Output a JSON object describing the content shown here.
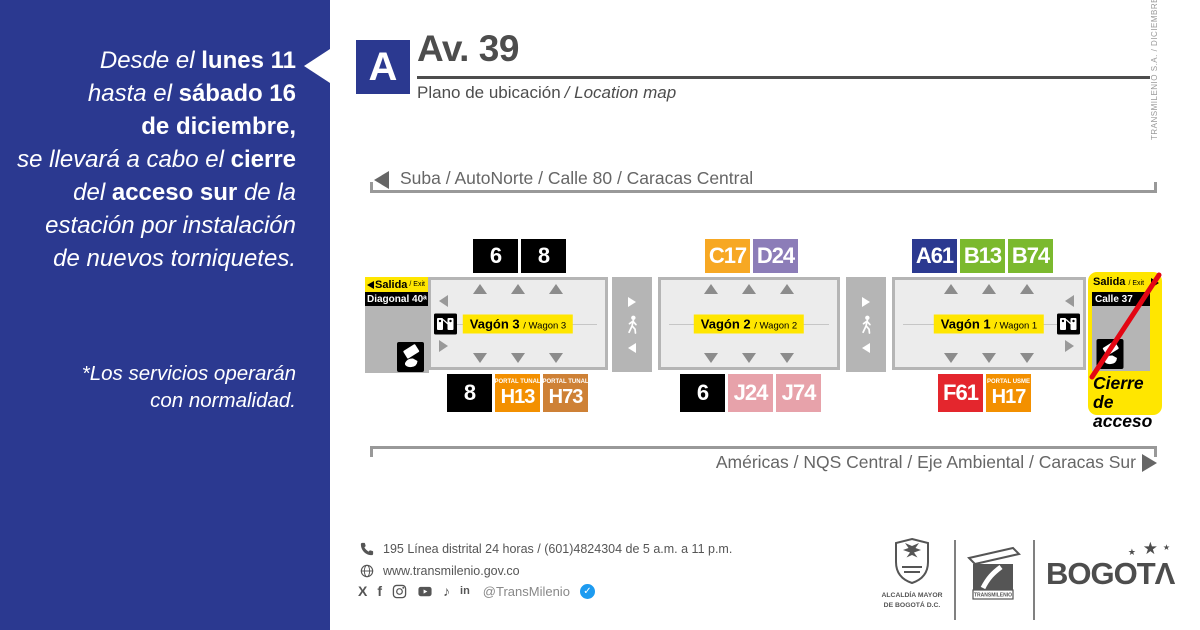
{
  "colors": {
    "brand_blue": "#2B3990",
    "accent_yellow": "#FFE600",
    "platform_gray": "#B5B5B5",
    "closure_red": "#E30613",
    "verified_blue": "#1D9BF0"
  },
  "sidebar": {
    "message_lines": [
      [
        {
          "t": "Desde el ",
          "s": "i"
        },
        {
          "t": "lunes 11",
          "s": "b"
        }
      ],
      [
        {
          "t": "hasta el ",
          "s": "i"
        },
        {
          "t": "sábado 16",
          "s": "b"
        }
      ],
      [
        {
          "t": "de diciembre,",
          "s": "b"
        }
      ],
      [
        {
          "t": "se llevará a cabo el ",
          "s": "i"
        },
        {
          "t": "cierre",
          "s": "b"
        }
      ],
      [
        {
          "t": "del ",
          "s": "i"
        },
        {
          "t": "acceso sur",
          "s": "b"
        },
        {
          "t": " de la",
          "s": "i"
        }
      ],
      [
        {
          "t": "estación por instalación",
          "s": "i"
        }
      ],
      [
        {
          "t": "de nuevos torniquetes.",
          "s": "i"
        }
      ]
    ],
    "footnote_lines": [
      "*Los servicios operarán",
      "con normalidad."
    ]
  },
  "header": {
    "station_letter": "A",
    "station_name": "Av. 39",
    "subtitle_es": "Plano de ubicación",
    "subtitle_en": "/ Location map",
    "credit_vertical": "TRANSMILENIO S.A. / DICIEMBRE - 2023"
  },
  "directions": {
    "top_label": "Suba / AutoNorte / Calle 80 / Caracas Central",
    "bottom_label": "Américas / NQS Central / Eje Ambiental / Caracas Sur"
  },
  "station": {
    "exit_left": {
      "salida": "Salida",
      "exit_suffix": "/ Exit",
      "street": "Diagonal 40ᵃ"
    },
    "wagons": [
      {
        "id": "wagon-3",
        "name": "Vagón 3",
        "name_en": "/ Wagon 3",
        "top_badges": [
          {
            "label": "6",
            "bg": "#000000"
          },
          {
            "label": "8",
            "bg": "#000000"
          }
        ],
        "bottom_badges": [
          {
            "label": "8",
            "bg": "#000000"
          },
          {
            "label": "H13",
            "bg": "#F39000",
            "tag": "PORTAL TUNAL"
          },
          {
            "label": "H73",
            "bg": "#CE8136",
            "tag": "PORTAL TUNAL"
          }
        ]
      },
      {
        "id": "wagon-2",
        "name": "Vagón 2",
        "name_en": "/ Wagon 2",
        "top_badges": [
          {
            "label": "C17",
            "bg": "#F7A823"
          },
          {
            "label": "D24",
            "bg": "#8C7DB8"
          }
        ],
        "bottom_badges": [
          {
            "label": "6",
            "bg": "#000000"
          },
          {
            "label": "J24",
            "bg": "#E7A2AA"
          },
          {
            "label": "J74",
            "bg": "#E7A2AA"
          }
        ]
      },
      {
        "id": "wagon-1",
        "name": "Vagón 1",
        "name_en": "/ Wagon 1",
        "top_badges": [
          {
            "label": "A61",
            "bg": "#2B3990"
          },
          {
            "label": "B13",
            "bg": "#7BB92E"
          },
          {
            "label": "B74",
            "bg": "#7BB92E"
          }
        ],
        "bottom_badges": [
          {
            "label": "F61",
            "bg": "#E4262D"
          },
          {
            "label": "H17",
            "bg": "#F39000",
            "tag": "PORTAL USME"
          }
        ]
      }
    ],
    "closure": {
      "salida": "Salida",
      "exit_suffix": "/ Exit",
      "street": "Calle 37",
      "label_lines": [
        "Cierre de",
        "acceso"
      ]
    }
  },
  "footer": {
    "phone": "195 Línea distrital 24 horas / (601)4824304 de 5 a.m. a 11 p.m.",
    "website": "www.transmilenio.gov.co",
    "social_handle": "@TransMilenio",
    "logos": {
      "alcaldia_line1": "ALCALDÍA MAYOR",
      "alcaldia_line2": "DE BOGOTÁ D.C.",
      "transmilenio": "TRANSMILENIO",
      "bogota_prefix": "BOGOT",
      "bogota_accent": "Λ"
    }
  }
}
